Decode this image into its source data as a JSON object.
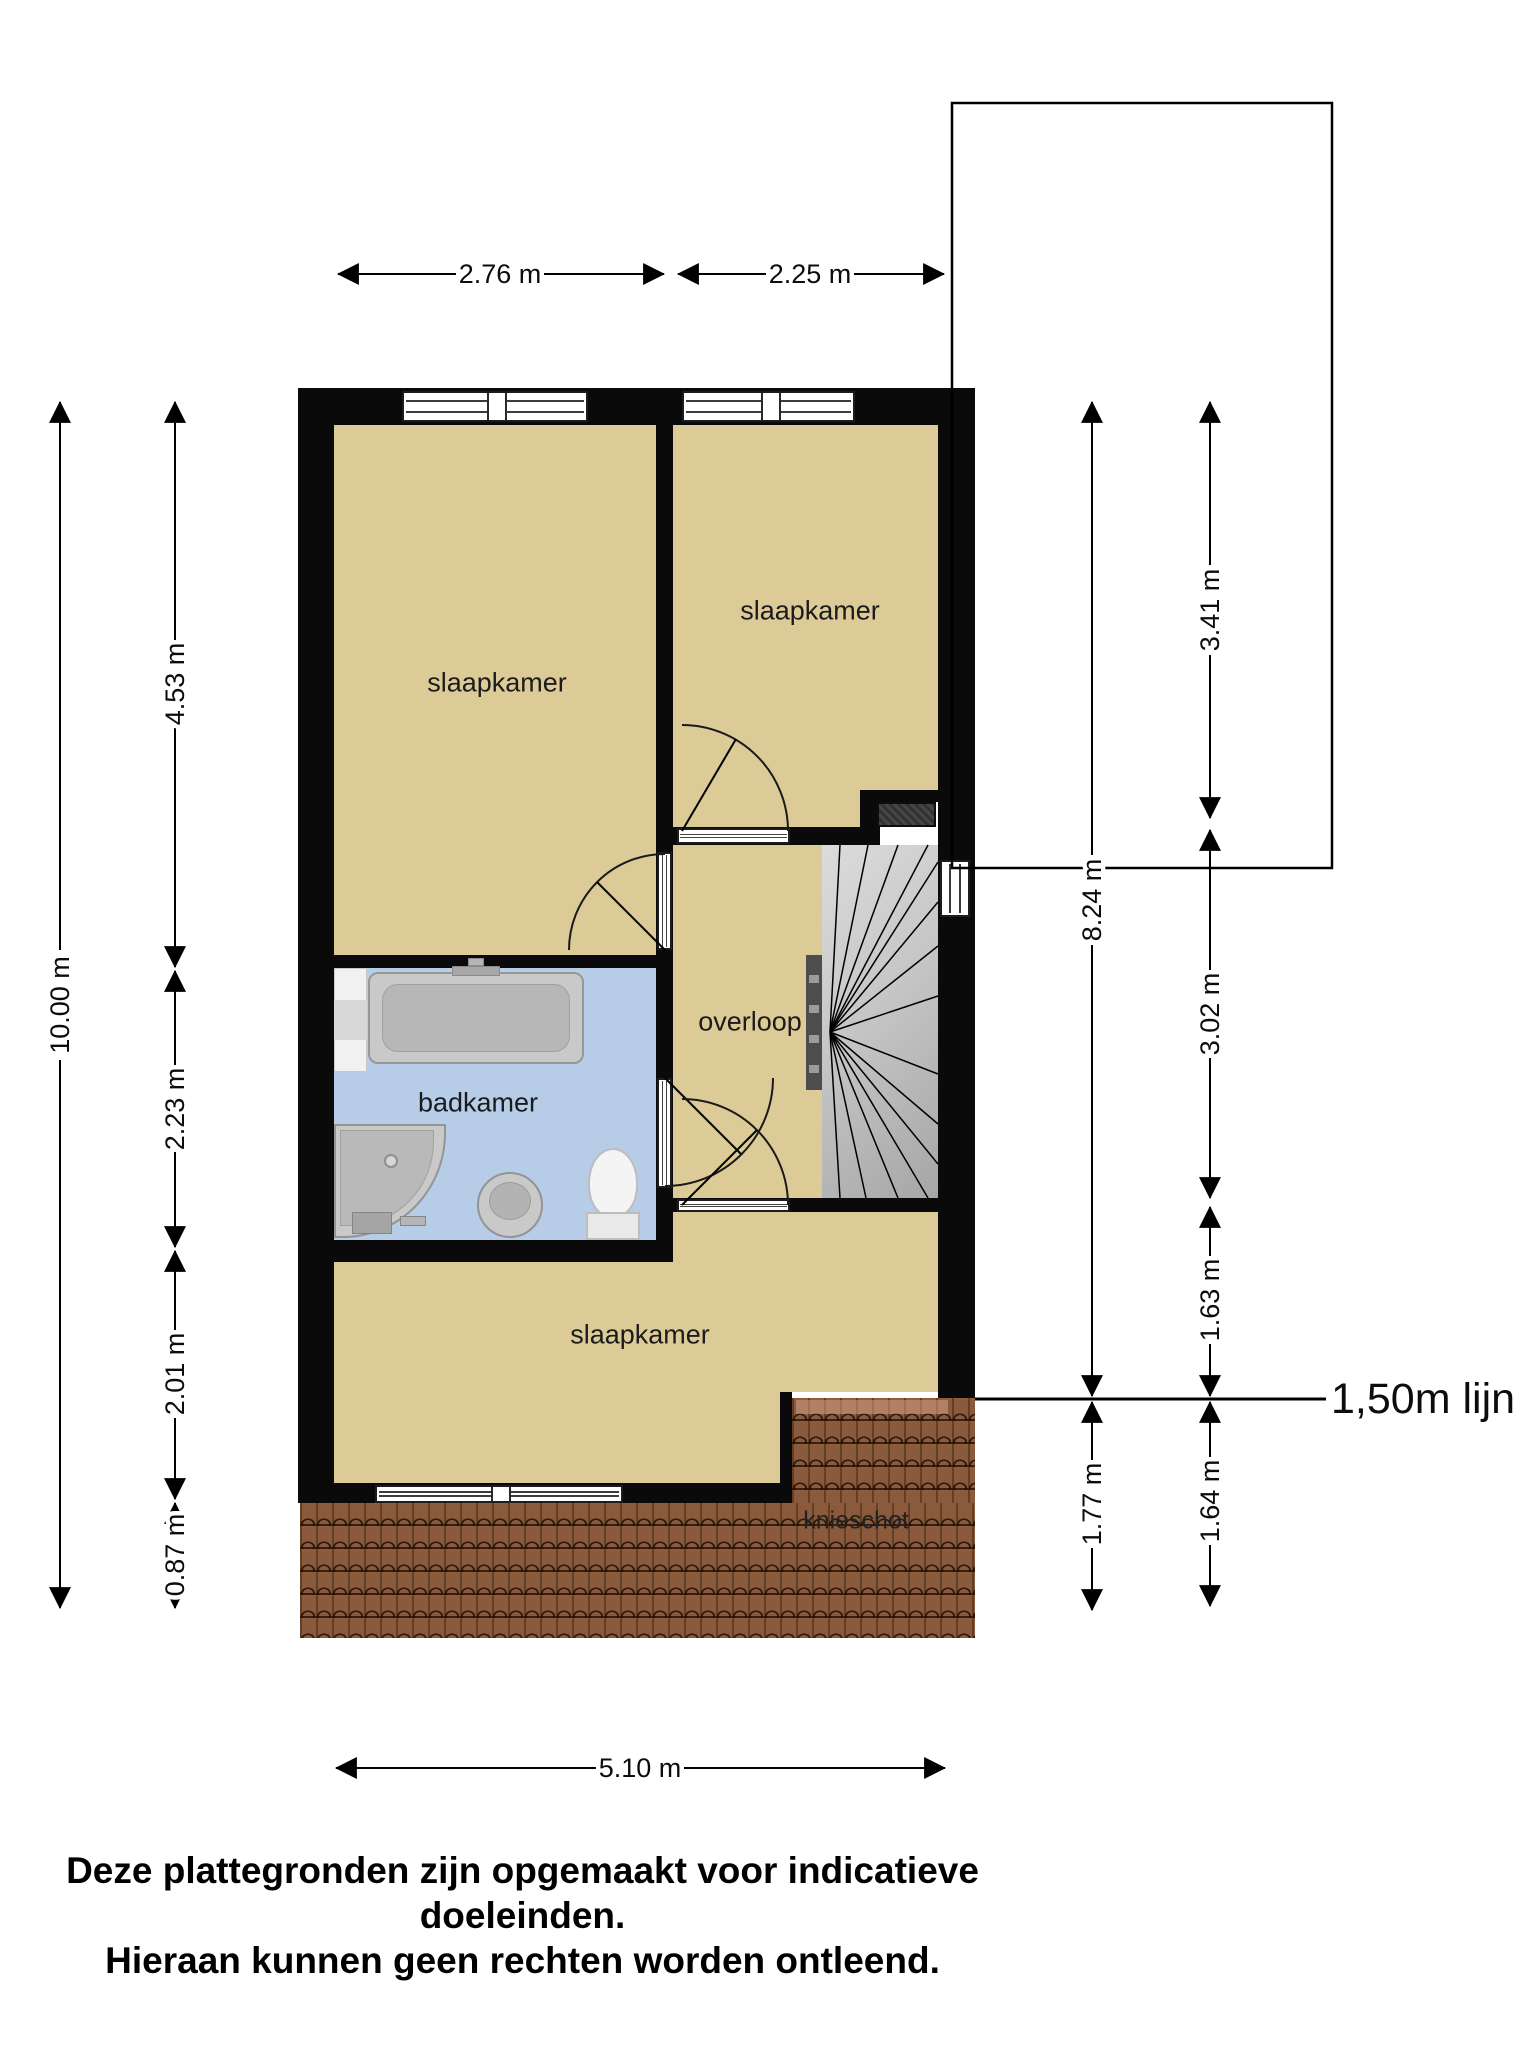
{
  "rooms": {
    "bedroom_left": "slaapkamer",
    "bedroom_right": "slaapkamer",
    "bedroom_bottom": "slaapkamer",
    "bathroom": "badkamer",
    "landing": "overloop",
    "kneewall": "knieschot"
  },
  "dimensions": {
    "top_left_width": "2.76 m",
    "top_right_width": "2.25 m",
    "bottom_width": "5.10 m",
    "total_height": "10.00 m",
    "left_seg1": "4.53 m",
    "left_seg2": "2.23 m",
    "left_seg3": "2.01 m",
    "left_seg4": "0.87 m",
    "right_outer_upper": "8.24 m",
    "right_outer_lower": "1.77 m",
    "right_inner_seg1": "3.41 m",
    "right_inner_seg2": "3.02 m",
    "right_inner_seg3": "1.63 m",
    "right_inner_seg4": "1.64 m"
  },
  "annotations": {
    "line_150": "1,50m lijn"
  },
  "disclaimer": {
    "line1": "Deze plattegronden zijn opgemaakt voor indicatieve doeleinden.",
    "line2": "Hieraan kunnen geen rechten worden ontleend."
  },
  "colors": {
    "wall": "#0a0a0a",
    "floor": "#dccb97",
    "bathroom-floor": "#b7cde7",
    "roof": "#8a5a3c",
    "stairs-light": "#dcdcdc",
    "stairs-dark": "#a6a6a6",
    "fixture": "#c9c9c9",
    "chimney": "#3a3a3a",
    "dimension": "#000000"
  }
}
